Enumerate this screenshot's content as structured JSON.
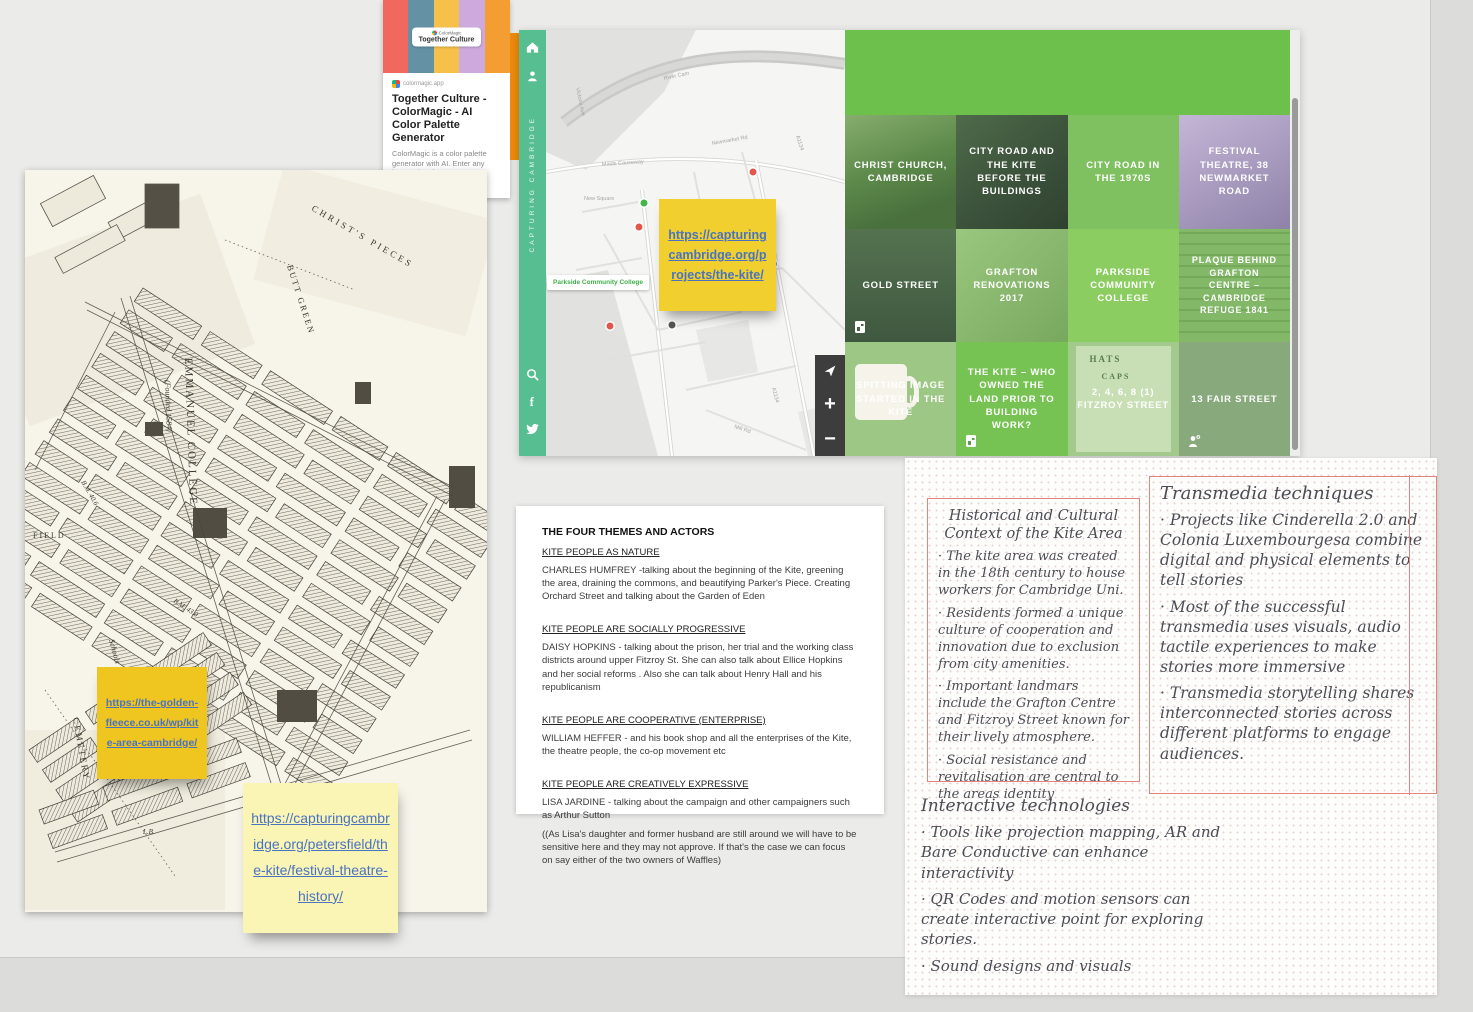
{
  "theme": {
    "board_bg": "#ebebe9",
    "margin_bg": "#dcdcda",
    "sidebar_green": "#57BE91",
    "tile_band_green": "#6CC04B",
    "sticky_yellow": "#F0CF2E",
    "sticky_gold": "#EFC51F",
    "sticky_pale_yellow": "#FAF4B5",
    "link_blue": "#4A73C0",
    "frame_red": "#E2837D"
  },
  "colormagic_card": {
    "palette_colors": [
      "#F0685E",
      "#6492A4",
      "#F5C14B",
      "#CDA9DD",
      "#F49D33"
    ],
    "brand": "ColorMagic",
    "palette_name": "Together Culture",
    "source": "colormagic.app",
    "title": "Together Culture - ColorMagic - AI Color Palette Generator",
    "description": "ColorMagic is a color palette generator with AI. Enter any keyword and generate a matching color palette."
  },
  "website": {
    "sidebar": {
      "vertical_title": "CAPTURING CAMBRIDGE",
      "facebook_glyph": "f"
    },
    "map": {
      "place_label": "Parkside Community College",
      "streets": [
        "River Cam",
        "Victoria Ave",
        "Maids Causeway",
        "Newmarket Rd",
        "A1134",
        "New Square",
        "City Rd",
        "Mill Rd",
        "A1134"
      ]
    },
    "controls": {
      "zoom_in": "+",
      "zoom_out": "−"
    },
    "tiles": [
      {
        "title": "CHRIST CHURCH, CAMBRIDGE"
      },
      {
        "title": "CITY ROAD AND THE KITE BEFORE THE BUILDINGS"
      },
      {
        "title": "CITY ROAD IN THE 1970S"
      },
      {
        "title": "FESTIVAL THEATRE, 38 NEWMARKET ROAD"
      },
      {
        "title": "GOLD STREET"
      },
      {
        "title": "GRAFTON RENOVATIONS 2017"
      },
      {
        "title": "PARKSIDE COMMUNITY COLLEGE"
      },
      {
        "title": "PLAQUE BEHIND GRAFTON CENTRE – CAMBRIDGE REFUGE 1841"
      },
      {
        "title": "SPITTING IMAGE STARTED IN THE KITE"
      },
      {
        "title": "THE KITE – WHO OWNED THE LAND PRIOR TO BUILDING WORK?"
      },
      {
        "title": "2, 4, 6, 8 (1) FITZROY STREET",
        "poster_top": "HATS",
        "poster_mid": "CAPS"
      },
      {
        "title": "13 FAIR STREET"
      }
    ]
  },
  "sticky_notes": {
    "projects": "https://capturingcambridge.org/projects/the-kite/",
    "golden_fleece": "https://the-golden-fleece.co.uk/wp/kite-area-cambridge/",
    "festival_theatre": "https://capturingcambridge.org/petersfield/the-kite/festival-theatre-history/"
  },
  "old_map": {
    "labels": {
      "college": "EMMANUEL COLLEGE",
      "college_sub": "(Founded 1584)",
      "pieces": "CHRIST'S PIECES",
      "butt_green": "BUTT GREEN",
      "cemetery": "CEMETERY",
      "schools": "Schools",
      "field": "FIELD",
      "bm1": "B.M. 43.0",
      "bm2": "B.M. 40.6",
      "lb": "L.B."
    }
  },
  "document": {
    "title": "THE FOUR THEMES AND ACTORS",
    "sections": [
      {
        "heading": "KITE PEOPLE AS NATURE",
        "body": "CHARLES HUMFREY -talking about the beginning of the Kite, greening the area, draining the commons, and beautifying Parker's Piece. Creating Orchard Street and talking about the Garden of Eden"
      },
      {
        "heading": "KITE PEOPLE ARE SOCIALLY PROGRESSIVE",
        "body": "DAISY HOPKINS -  talking about the prison, her trial and the working class districts around upper Fitzroy St. She can also talk about Ellice Hopkins and her social reforms . Also she can talk about Henry Hall and his republicanism"
      },
      {
        "heading": "KITE PEOPLE ARE COOPERATIVE (ENTERPRISE)",
        "body": "WILLIAM HEFFER - and his book shop and all the enterprises of the Kite, the theatre people, the co-op movement etc"
      },
      {
        "heading": "KITE PEOPLE ARE CREATIVELY EXPRESSIVE",
        "body": "LISA JARDINE - talking about the campaign and other campaigners such as Arthur Sutton",
        "body2": "((As Lisa's daughter and former husband are still around we will have to be sensitive here and they may not approve. If that's the case we can focus on say either of the two owners of Waffles)"
      }
    ]
  },
  "handwritten": {
    "historical": {
      "title": "Historical and Cultural Context of the Kite Area",
      "bullets": [
        "· The kite area was created in the 18th century to house workers for Cambridge Uni.",
        "· Residents formed a unique culture of cooperation and innovation due to exclusion from city amenities.",
        "· Important landmars include the Grafton Centre and Fitzroy Street known for their lively atmosphere.",
        "· Social resistance and revitalisation are central to the areas identity"
      ]
    },
    "transmedia": {
      "title": "Transmedia techniques",
      "bullets": [
        "· Projects like Cinderella 2.0 and Colonia Luxembourgesa combine digital and physical elements to tell stories",
        "· Most of the successful transmedia uses visuals, audio tactile experiences to make stories more immersive",
        "· Transmedia storytelling shares interconnected stories across different platforms to engage audiences."
      ]
    },
    "interactive": {
      "title": "Interactive technologies",
      "bullets": [
        "· Tools like projection mapping, AR and Bare Conductive can enhance interactivity",
        "· QR Codes and motion sensors can create interactive point for exploring stories.",
        "· Sound designs and visuals"
      ]
    }
  }
}
